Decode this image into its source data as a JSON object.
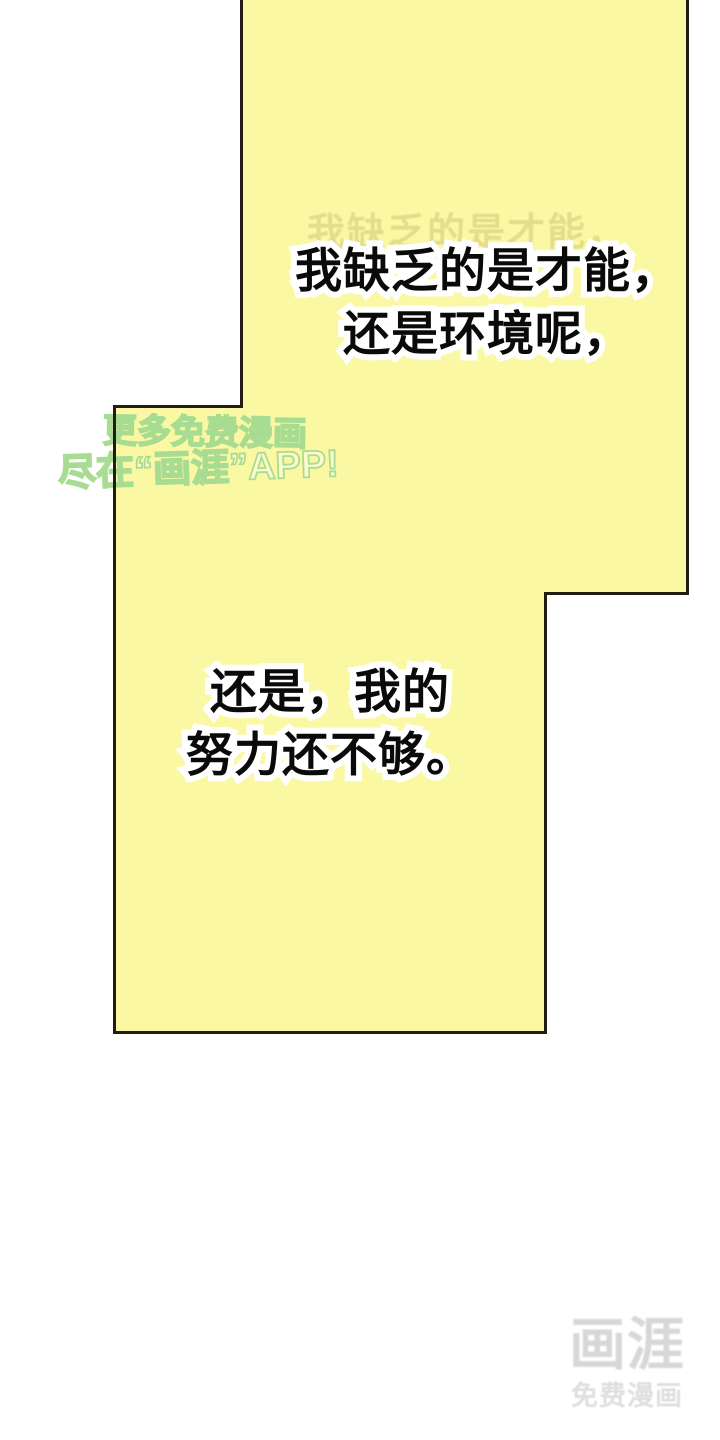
{
  "page": {
    "background_color": "#ffffff"
  },
  "comic": {
    "panel_fill_color": "#FBF8A3",
    "panel_border_color": "#221d12",
    "panel1": {
      "ghost_line": "我缺乏的是才能，",
      "line1": "我缺乏的是才能，",
      "line2": "还是环境呢，"
    },
    "panel2": {
      "line1": "还是，我的",
      "line2": "努力还不够。"
    }
  },
  "watermark": {
    "line1": "更多免费漫画",
    "line2": "尽在“画涯”APP!",
    "outline_color": "#a9dc93"
  },
  "brand": {
    "logo_text": "画涯",
    "tagline": "免费漫画",
    "color": "#d7d7d7"
  }
}
